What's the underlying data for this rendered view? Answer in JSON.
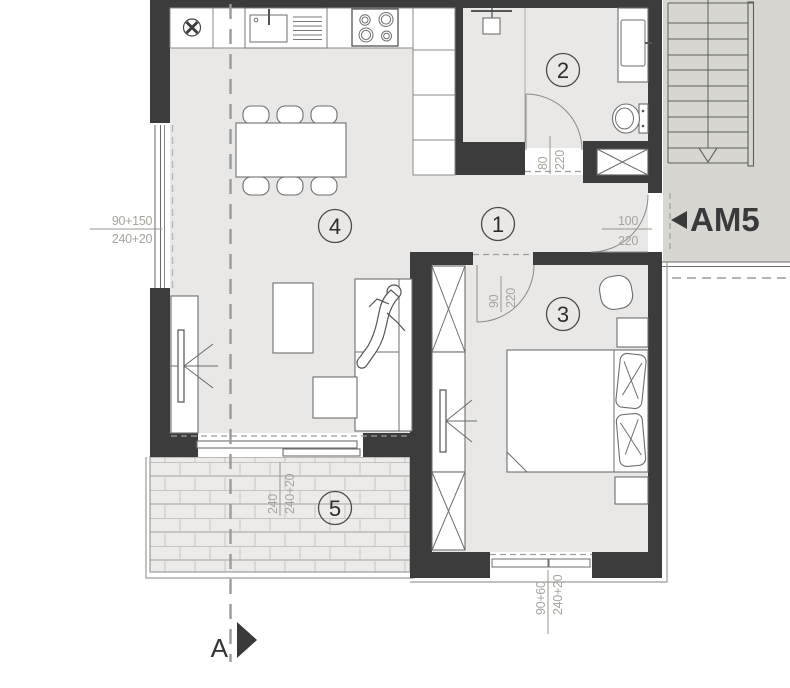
{
  "plan": {
    "labels": {
      "entry": "AM5",
      "section": "A"
    },
    "rooms": [
      {
        "number": "1"
      },
      {
        "number": "2"
      },
      {
        "number": "3"
      },
      {
        "number": "4"
      },
      {
        "number": "5"
      }
    ],
    "dimensions": {
      "left_window": {
        "top": "90+150",
        "bottom": "240+20"
      },
      "bathroom_door": {
        "width": "80",
        "height": "220"
      },
      "entry_door": {
        "width": "100",
        "height": "220"
      },
      "bedroom_door": {
        "width": "90",
        "height": "220"
      },
      "balcony": {
        "top": "240",
        "bottom": "240+20"
      },
      "bedroom_window": {
        "top": "90+60",
        "bottom": "240+20"
      }
    },
    "colors": {
      "wall": "#3c3c3c",
      "floor": "#e9e8e6",
      "corridor": "#d8d6d1",
      "dimension_text": "#a8a49d",
      "drawing_line": "#555555"
    }
  }
}
